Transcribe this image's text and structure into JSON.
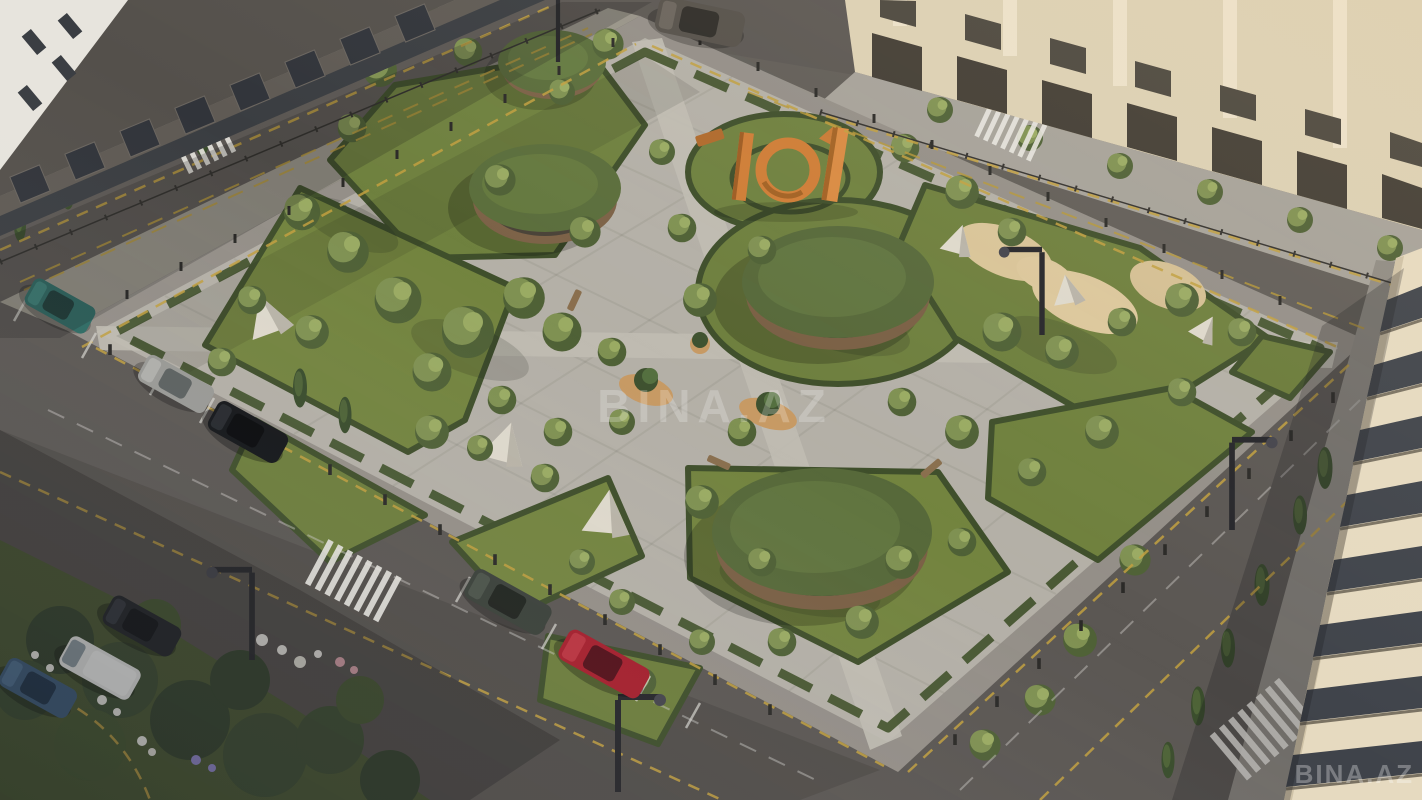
{
  "image": {
    "kind": "aerial-3d-architectural-render",
    "subject": "Landscaped residential courtyard park with round green-roof pavilions, diagonal stone paths, hedged lawns, parked cars and surrounding beige apartment buildings"
  },
  "watermarks": {
    "center": "BINA.AZ",
    "bottom_right": "BINA.AZ"
  },
  "scene": {
    "sculpture": {
      "label": "101",
      "color": "#cf7d36"
    },
    "pavilions": {
      "count": 4,
      "roof_color": "#5b6e3c"
    },
    "crosswalks": {
      "count": 4
    },
    "vehicles": [
      {
        "name": "teal-hatchback",
        "color": "#2d6b64"
      },
      {
        "name": "silver-sedan",
        "color": "#9a9a96"
      },
      {
        "name": "black-suv",
        "color": "#141619"
      },
      {
        "name": "olive-sedan",
        "color": "#3b413a"
      },
      {
        "name": "red-sedan",
        "color": "#a61f2d"
      },
      {
        "name": "dark-suv",
        "color": "#1f2226"
      },
      {
        "name": "white-van",
        "color": "#e4e4e0"
      },
      {
        "name": "blue-sedan",
        "color": "#3c5a78"
      },
      {
        "name": "gray-suv-driving",
        "color": "#55504a"
      }
    ],
    "palette": {
      "asphalt": "#5b5753",
      "sidewalk": "#a09c95",
      "park_paving": "#b4b0a7",
      "lawn": "#72833f",
      "hedge": "#3f4f2b",
      "tree_light": "#8a9b58",
      "tree_dark": "#55673a",
      "building_beige": "#dcd0b4",
      "building_cream": "#e6dac0",
      "building_dark": "#54504b",
      "curb_yellow": "#c2a040",
      "play_surface": "#dcc79c",
      "planter_terracotta": "#c79a64",
      "sculpture_orange": "#cf7d36"
    }
  }
}
